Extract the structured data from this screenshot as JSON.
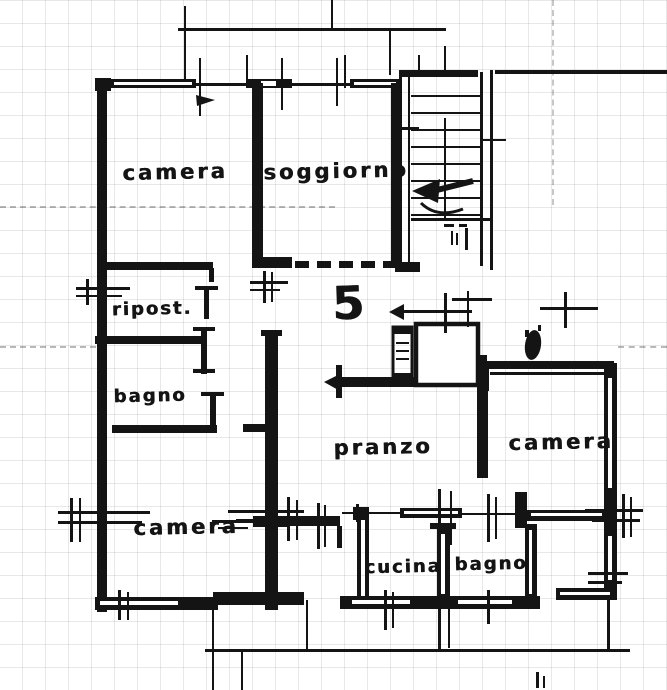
{
  "document": {
    "kind": "apartment floor plan (scanned)",
    "language": "Italian"
  },
  "unit": {
    "number": "5"
  },
  "rooms": [
    {
      "id": "camera-nw",
      "label": "camera"
    },
    {
      "id": "soggiorno",
      "label": "soggiorno"
    },
    {
      "id": "ripostiglio",
      "label": "ripost."
    },
    {
      "id": "bagno-w",
      "label": "bagno"
    },
    {
      "id": "pranzo",
      "label": "pranzo"
    },
    {
      "id": "camera-e",
      "label": "camera"
    },
    {
      "id": "camera-sw",
      "label": "camera"
    },
    {
      "id": "cucina",
      "label": "cucina"
    },
    {
      "id": "bagno-s",
      "label": "bagno"
    }
  ],
  "features": {
    "staircase": "communal stair with down arrow",
    "elevator": "elevator shaft",
    "duct": "service shaft",
    "entry": "dashed entry opening",
    "balcony": "terrace / balcony lines"
  },
  "colors": {
    "ink": "#141414",
    "paper": "#ffffff"
  }
}
